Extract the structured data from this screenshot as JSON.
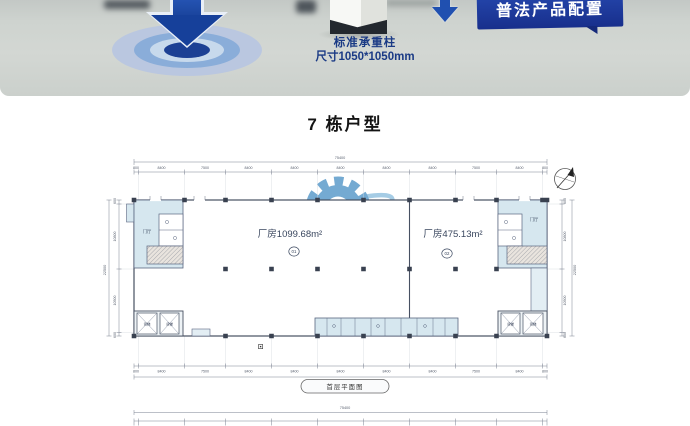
{
  "photo": {
    "banner": "普法产品配置",
    "caption_line1": "标准承重柱",
    "caption_line2": "尺寸1050*1050mm"
  },
  "section_title": "7 栋户型",
  "floor_plan": {
    "caption": "首层平面图",
    "unit_left": {
      "name": "厂房1099.68m²",
      "number": "01"
    },
    "unit_right": {
      "name": "厂房475.13m²",
      "number": "02"
    },
    "rooms": {
      "entry_hall_left": "门厅",
      "entry_hall_right": "门厅",
      "freight_elevator": "货梯"
    },
    "dims": {
      "top_total": "75400",
      "bottom_total": "75400",
      "left_total": "22500",
      "right_total": "22500",
      "top_segments": [
        "800",
        "8400",
        "7500",
        "8400",
        "8400",
        "8400",
        "8400",
        "8400",
        "7500",
        "8400",
        "800"
      ],
      "bottom_segments": [
        "800",
        "8400",
        "7500",
        "8400",
        "8400",
        "8400",
        "8400",
        "8400",
        "7500",
        "8400",
        "800"
      ],
      "left_segments": [
        "600",
        "10800",
        "10500",
        "600"
      ],
      "right_segments": [
        "600",
        "10800",
        "10500",
        "600"
      ]
    }
  },
  "next_plan": {
    "top_total": "75400"
  }
}
